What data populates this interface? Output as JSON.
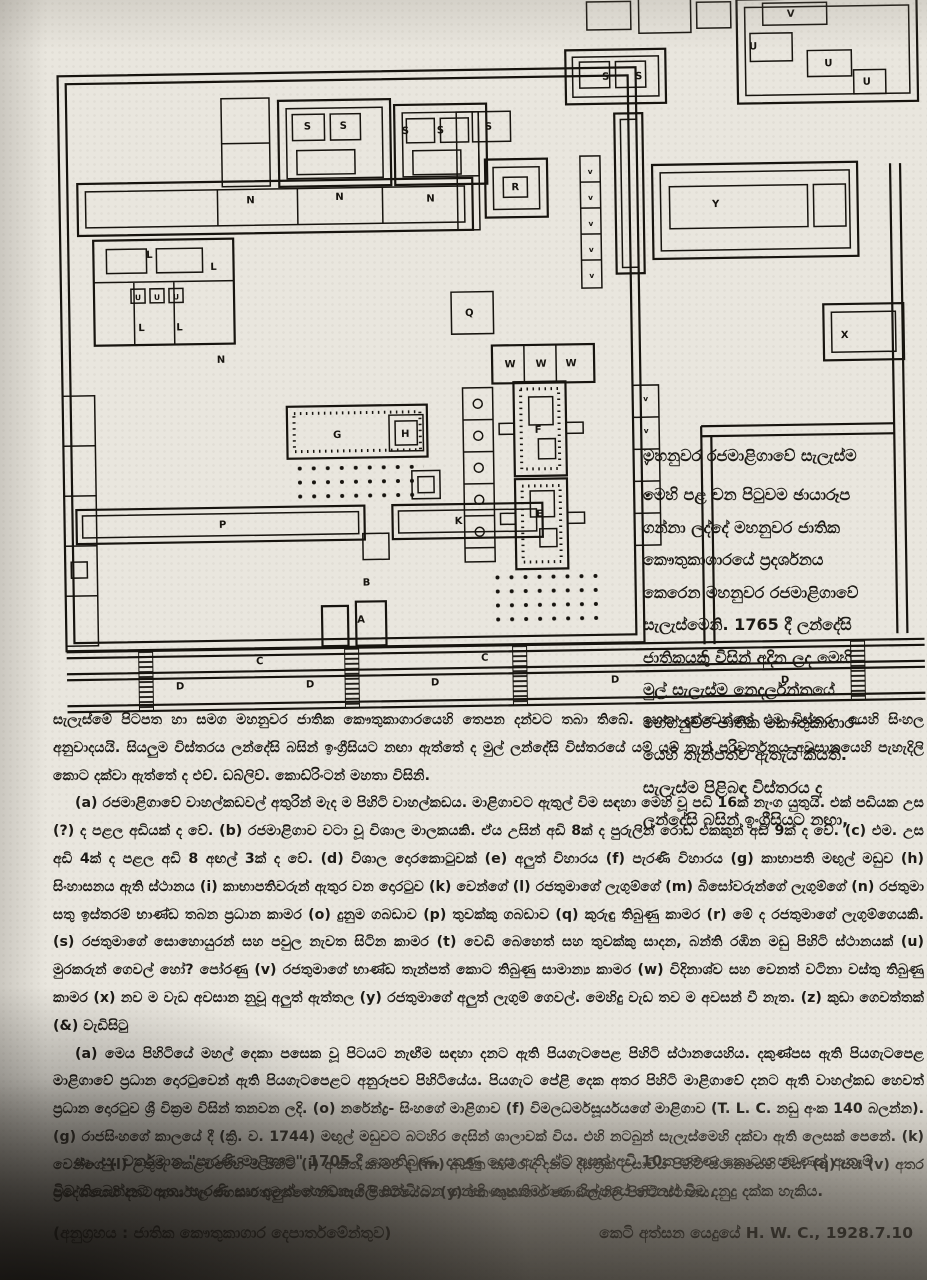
{
  "plan": {
    "name": "Plan of the Royal Palace of Kandy (මහනුවර රජමාළිගාව) — measured drawing",
    "labels": [
      {
        "t": "S",
        "x": 311,
        "y": 127
      },
      {
        "t": "S",
        "x": 347,
        "y": 127
      },
      {
        "t": "S",
        "x": 409,
        "y": 133
      },
      {
        "t": "S",
        "x": 444,
        "y": 133
      },
      {
        "t": "S",
        "x": 492,
        "y": 130
      },
      {
        "t": "S",
        "x": 610,
        "y": 82
      },
      {
        "t": "S",
        "x": 643,
        "y": 82
      },
      {
        "t": "V",
        "x": 796,
        "y": 22
      },
      {
        "t": "U",
        "x": 758,
        "y": 54
      },
      {
        "t": "U",
        "x": 833,
        "y": 72
      },
      {
        "t": "U",
        "x": 871,
        "y": 91
      },
      {
        "t": "R",
        "x": 518,
        "y": 191
      },
      {
        "t": "N",
        "x": 253,
        "y": 200
      },
      {
        "t": "N",
        "x": 342,
        "y": 198
      },
      {
        "t": "N",
        "x": 433,
        "y": 201
      },
      {
        "t": "L",
        "x": 151,
        "y": 253
      },
      {
        "t": "L",
        "x": 215,
        "y": 266
      },
      {
        "t": "U",
        "x": 139,
        "y": 295,
        "s": 1
      },
      {
        "t": "U",
        "x": 158,
        "y": 295,
        "s": 1
      },
      {
        "t": "U",
        "x": 177,
        "y": 295,
        "s": 1
      },
      {
        "t": "L",
        "x": 142,
        "y": 326
      },
      {
        "t": "L",
        "x": 180,
        "y": 326
      },
      {
        "t": "N",
        "x": 221,
        "y": 359
      },
      {
        "t": "Q",
        "x": 470,
        "y": 316
      },
      {
        "t": "W",
        "x": 510,
        "y": 368
      },
      {
        "t": "W",
        "x": 541,
        "y": 368
      },
      {
        "t": "W",
        "x": 571,
        "y": 368
      },
      {
        "t": "Y",
        "x": 718,
        "y": 211
      },
      {
        "t": "X",
        "x": 845,
        "y": 344
      },
      {
        "t": "G",
        "x": 336,
        "y": 436
      },
      {
        "t": "H",
        "x": 404,
        "y": 436
      },
      {
        "t": "F",
        "x": 537,
        "y": 434
      },
      {
        "t": "E",
        "x": 537,
        "y": 518
      },
      {
        "t": "P",
        "x": 220,
        "y": 524
      },
      {
        "t": "K",
        "x": 456,
        "y": 524
      },
      {
        "t": "B",
        "x": 363,
        "y": 584
      },
      {
        "t": "A",
        "x": 357,
        "y": 621
      },
      {
        "t": "C",
        "x": 255,
        "y": 661
      },
      {
        "t": "C",
        "x": 480,
        "y": 661
      },
      {
        "t": "C",
        "x": 700,
        "y": 661
      },
      {
        "t": "D",
        "x": 175,
        "y": 685
      },
      {
        "t": "D",
        "x": 305,
        "y": 685
      },
      {
        "t": "D",
        "x": 430,
        "y": 685
      },
      {
        "t": "D",
        "x": 610,
        "y": 685
      },
      {
        "t": "D",
        "x": 780,
        "y": 688
      },
      {
        "t": "v",
        "x": 593,
        "y": 176,
        "s": 1
      },
      {
        "t": "v",
        "x": 593,
        "y": 202,
        "s": 1
      },
      {
        "t": "v",
        "x": 593,
        "y": 228,
        "s": 1
      },
      {
        "t": "v",
        "x": 593,
        "y": 254,
        "s": 1
      },
      {
        "t": "v",
        "x": 593,
        "y": 280,
        "s": 1
      },
      {
        "t": "v",
        "x": 645,
        "y": 404,
        "s": 1
      },
      {
        "t": "v",
        "x": 645,
        "y": 436,
        "s": 1
      },
      {
        "t": "v",
        "x": 645,
        "y": 468,
        "s": 1
      },
      {
        "t": "v",
        "x": 645,
        "y": 500,
        "s": 1
      }
    ]
  },
  "caption": {
    "title": "මහනුවර රජමාළිගාවේ සැලැස්ම",
    "lines": [
      "මෙහි පළ වන පිටුවම ඡායාරූප",
      "ගන්නා ලද්දේ මහනුවර ජාතික",
      "කෞතුකාගාරයේ ප්‍රදර්ශනය",
      "කෙරෙන මහනුවර රජමාළිගාවේ",
      "සැලැස්මෙනි. 1765 දී ලන්දේසි",
      "ජාතිකයකු විසින් අදින ලද මෙහි",
      "මුල් සැලැස්ම නෙදර්ලන්තයේ",
      "හේග්නුවර ජාතික කෞතුකාගාර-",
      "යෙහි තැන්පත්ව ඇතැයි කියති.",
      "සැලැස්ම පිළිබඳ විස්තරය ද",
      "ලන්දේසි බසින් ඉංග්‍රීසියට නඟා,"
    ]
  },
  "body": {
    "para1": [
      "සැලැස්මේ පිටපත හා සමග මහනුවර ජාතික කෞතුකාගාරයෙහි තෙපන දන්වට තබා තිබේ. ඉහත දැක්වෙන්නේ එම විස්තර-",
      "යෙහි සිංහල අනුවාදයයි. සියලුම විස්තරය ලන්දේසි බසින් ඉංග්‍රීසියට නඟා ඇත්තේ ද මුල් ලන්දේසි විස්තරයේ යම් යම්",
      "තැන් පරිවර්තනය අවසානයෙහි පැහැදිලි කොට දක්වා ඇත්තේ ද එච්. ඩබ්ලිව්. කොඩ්රිංටන් මහතා විසිනි."
    ],
    "para2": [
      "(a) රජමාළිගාවේ වාහල්කඩවල් අතුරින් මැද ම පිහිටි වාහල්කඩය. මාළිගාවට ඇතුල් විම සඳහා මෙහි වූ පඩි 16ක්",
      "නැංග යුතුයි. එක් පඩියක උස (?) ද පළල අඩියක් ද වේ. (b) රජමාළිගාව වටා වූ විශාල මාලකයකි. ඒය උසින් අඩි 8ක්",
      "ද පුරුලින් රොඩ එකකුන් අඩි 9ක් ද වේ. (c) එම. උස අඩි 4ක් ද පළල අඩි 8 අඟල් 3ක් ද වේ. (d) විශාල දොරකොටුවක්",
      "(e) අලුත් විහාරය (f) පැරණි විහාරය (g) කාභාපති මඟුල් මඩුව (h) සිංහාසනය ඇති ස්ථානය (i) කාභාපතිවරුන්",
      "ඇතුර වන දොරටුව (k) වෙන්ගේ (l) රජතුමාගේ ලැගුම්ගේ (m) බිසෝවරුන්ගේ ලැගුම්ගේ (n) රජතුමා සතු ඉස්තරම්",
      "භාණ්ඩ තබන ප්‍රධාන කාමර (o) දුනුම ගබඩාව (p) තුවක්කු ගබඩාව (q) කුරුඳු තිබුණු කාමර (r) මේ ද රජතුමාගේ",
      "ලැගුම්ගෙයකි. (s) රජතුමාගේ සොහොයුරන් සහ පවුල නැවත සිටින කාමර (t) වෙඩි බෙහෙත් සහ තුවක්කු සාදන, බන්ති",
      "රඹින මඩු පිහිටි ස්ථානයක් (u) මුරකරුන් ගෙවල් හෝ? පෝරණු (v) රජතුමාගේ භාණ්ඩ තැන්පත් කොට තිබුණු සාමාන්‍ය",
      "කාමර (w) විදිනාශ්ව සහ වෙනත් වටිනා වස්තු තිබුණු කාමර (x) නව ම වැඩ අවසාන නුවූ අලුත් ඇත්තල (y)",
      "රජතුමාගේ අලුත් ලැගුම් ගෙවල්. මෙහිදු වැඩ තව ම අවසන් වී නැත. (z) කුඩා ගෙවත්තක් (&) වැඩිසිටු"
    ],
    "para3": [
      "(a) මෙය පිහිටියේ මහල් දෙකා පසෙක වූ පිටයට නැඟීම සඳහා දනට ඇති පියගැටපෙළ පිහිටි ස්ථානයෙහිය.",
      "දකුණ්පස ඇති පියගැටපෙළ මාළිගාවේ ප්‍රධාන දොරටුවෙන් ඇති පියගැටපෙළට අනුරූපව පිහිටියේය. පියගැට පේළි",
      "දෙක අතර පිහිටි මාළිගාවේ දනට ඇති වාහල්කඩ හෙවත් ප්‍රධාන දොරටුව ශ්‍රී වික්‍රම විසින් තනවන ලදි. (o) නරේන්ද්‍ර-",
      "සිංහගේ මාළිගාව (f) විමලධර්මසූර්යයගේ මාළිගාව (T. L. C. නඩු අංක 140 බලන්න). (g) රාජසිංහගේ කාලයේ දී (ක්‍රි. ව.",
      "1744) මඟුල් මඩුවට බටහිර දෙසින් ශාලාවක් විය. එහි නටබුන් සැලැස්මෙහි දක්වා ඇති ලෙසක් පෙනේ. (k) වෙන්ගේ",
      "(l) උතුරු කෙළවරෙහි ම පිහිටි (i) අංකිත කාමර ද (m) අංකිත කාමර ද දනට දිස්ත්‍රික් උසාවිය පිහිටි ස්ථානයෙහි විය. (q) සහ",
      "(v) අතර ප්‍රදේශයෙහි දනට කාර්යාල සහකාරතුමන්ගේ නිවාසය පිහිටියේය. (y) කෞතුකාගාර ගොඩනැගිලි පිහිටි ස්ථානය."
    ]
  },
  "note": {
    "lines": [
      "සැ. යු. වර්තමාන \"පැරණි මාළිගාව\" 1705 දී නොතිබුණ. දකුණු දෙස ඇති ඒට අයත් අඩි 10ක පමණ කොටස",
      "පමණක් ඇතැම් විට තිබෙන්නට ඇත. පැරණි සහ අලුත් ගොඩනැගිලි සන්ධි වන තන්හි ගෘහනිර්මාණ ශිල්පයේ",
      "වෙනස් වීම දනුදු දක්ක හැකිය."
    ]
  },
  "footer": {
    "credit": "(අනුග්‍රහය : ජාතික කෞතුකාගාර දෙපාර්තමේන්තුව)",
    "signature": "කෙටි අත්සන යෙදුයේ  H. W. C.,  1928.7.10"
  }
}
